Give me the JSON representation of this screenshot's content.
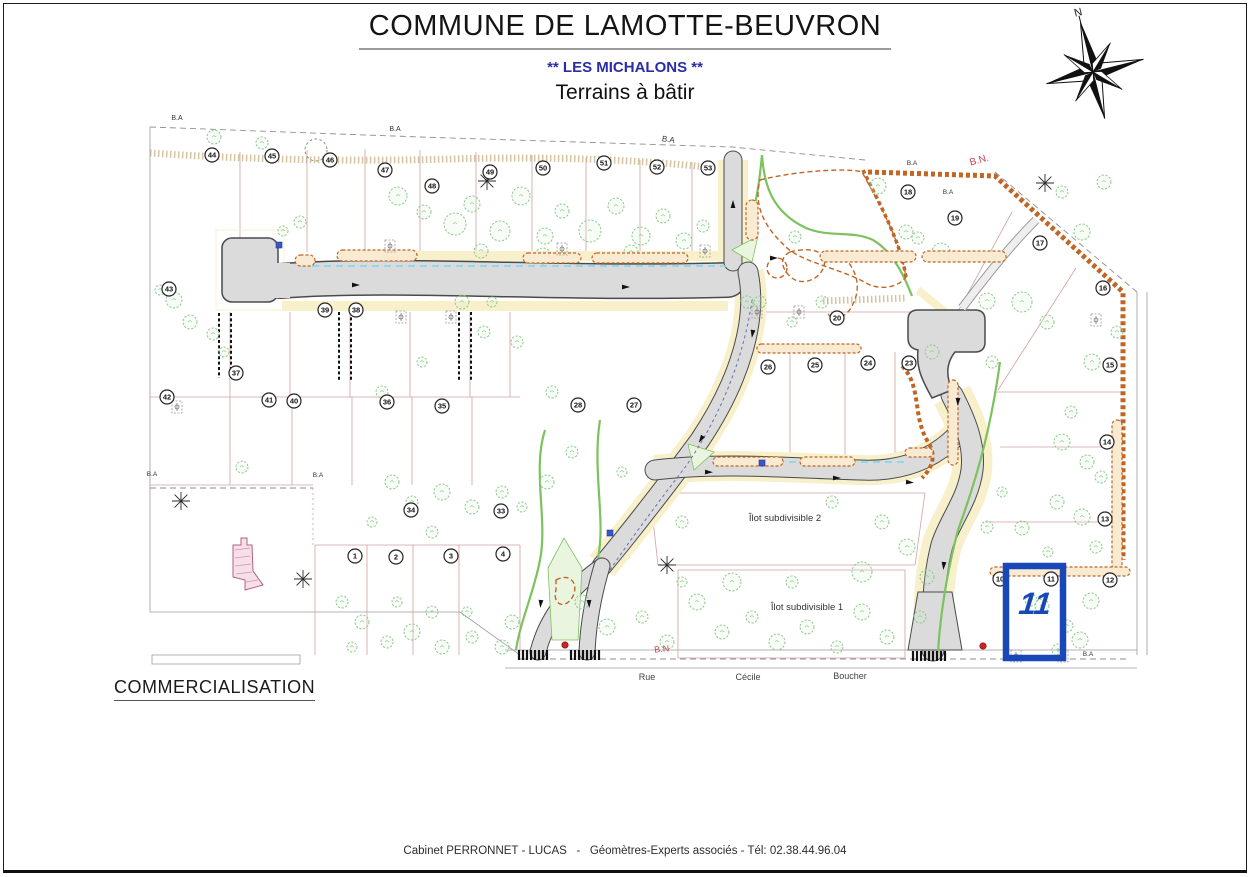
{
  "header": {
    "title": "COMMUNE DE LAMOTTE-BEUVRON",
    "subtitle": "** LES MICHALONS **",
    "subtitle2": "Terrains à bâtir"
  },
  "compass": {
    "label": "N"
  },
  "commercialisation": "COMMERCIALISATION",
  "footer": {
    "credit": "Cabinet PERRONNET - LUCAS   -   Géomètres-Experts associés - Tél: 02.38.44.96.04"
  },
  "map": {
    "colors": {
      "road": "#dbdbdb",
      "road_edge": "#4a4a4a",
      "sidewalk": "#f8f0cb",
      "tree": "#8cc98c",
      "hedge": "#c06524",
      "plot_line": "#d2a0a0",
      "water": "#86d8ec",
      "highlight": "#1848b8",
      "label_red": "#cc4455"
    },
    "highlight": {
      "number": "11",
      "x": 1006,
      "y": 566,
      "w": 57,
      "h": 92
    },
    "labels": [
      {
        "t": "B.A",
        "x": 177,
        "y": 120,
        "s": 7,
        "c": "#333",
        "r": 0
      },
      {
        "t": "B.A",
        "x": 395,
        "y": 131,
        "s": 7,
        "c": "#333",
        "r": 0
      },
      {
        "t": "B.A",
        "x": 668,
        "y": 142,
        "s": 8,
        "c": "#333",
        "r": 8
      },
      {
        "t": "B.A",
        "x": 912,
        "y": 165,
        "s": 6.5,
        "c": "#333",
        "r": 0
      },
      {
        "t": "B.A",
        "x": 948,
        "y": 194,
        "s": 6.5,
        "c": "#333",
        "r": 0
      },
      {
        "t": "B.A",
        "x": 152,
        "y": 476,
        "s": 6.5,
        "c": "#333",
        "r": 0
      },
      {
        "t": "B.A",
        "x": 318,
        "y": 477,
        "s": 6.5,
        "c": "#333",
        "r": 0
      },
      {
        "t": "B.A",
        "x": 1088,
        "y": 656,
        "s": 6.5,
        "c": "#333",
        "r": 0
      },
      {
        "t": "B.N.",
        "x": 980,
        "y": 163,
        "s": 10,
        "c": "#cc4455",
        "r": -16
      },
      {
        "t": "B.N",
        "x": 662,
        "y": 652,
        "s": 9,
        "c": "#cc4455",
        "r": -6
      },
      {
        "t": "Îlot subdivisible 2",
        "x": 785,
        "y": 521,
        "s": 9.5,
        "c": "#333",
        "r": 0
      },
      {
        "t": "Îlot subdivisible 1",
        "x": 807,
        "y": 610,
        "s": 9.5,
        "c": "#333",
        "r": 0
      },
      {
        "t": "Rue",
        "x": 647,
        "y": 680,
        "s": 9,
        "c": "#444",
        "r": 0
      },
      {
        "t": "Cécile",
        "x": 748,
        "y": 680,
        "s": 9,
        "c": "#444",
        "r": 0
      },
      {
        "t": "Boucher",
        "x": 850,
        "y": 679,
        "s": 9,
        "c": "#444",
        "r": 0
      }
    ],
    "plot_numbers": [
      {
        "n": "44",
        "x": 212,
        "y": 155
      },
      {
        "n": "45",
        "x": 272,
        "y": 156
      },
      {
        "n": "46",
        "x": 330,
        "y": 160
      },
      {
        "n": "47",
        "x": 385,
        "y": 170
      },
      {
        "n": "48",
        "x": 432,
        "y": 186
      },
      {
        "n": "49",
        "x": 490,
        "y": 172
      },
      {
        "n": "50",
        "x": 543,
        "y": 168
      },
      {
        "n": "51",
        "x": 604,
        "y": 163
      },
      {
        "n": "52",
        "x": 657,
        "y": 167
      },
      {
        "n": "53",
        "x": 708,
        "y": 168
      },
      {
        "n": "18",
        "x": 908,
        "y": 192
      },
      {
        "n": "19",
        "x": 955,
        "y": 218
      },
      {
        "n": "17",
        "x": 1040,
        "y": 243
      },
      {
        "n": "16",
        "x": 1103,
        "y": 288
      },
      {
        "n": "15",
        "x": 1110,
        "y": 365
      },
      {
        "n": "14",
        "x": 1107,
        "y": 442
      },
      {
        "n": "13",
        "x": 1105,
        "y": 519
      },
      {
        "n": "12",
        "x": 1110,
        "y": 580
      },
      {
        "n": "11",
        "x": 1051,
        "y": 579
      },
      {
        "n": "10",
        "x": 1000,
        "y": 579
      },
      {
        "n": "20",
        "x": 837,
        "y": 318
      },
      {
        "n": "26",
        "x": 768,
        "y": 367
      },
      {
        "n": "25",
        "x": 815,
        "y": 365
      },
      {
        "n": "24",
        "x": 868,
        "y": 363
      },
      {
        "n": "23",
        "x": 909,
        "y": 363
      },
      {
        "n": "43",
        "x": 169,
        "y": 289
      },
      {
        "n": "39",
        "x": 325,
        "y": 310
      },
      {
        "n": "38",
        "x": 356,
        "y": 310
      },
      {
        "n": "37",
        "x": 236,
        "y": 373
      },
      {
        "n": "36",
        "x": 387,
        "y": 402
      },
      {
        "n": "35",
        "x": 442,
        "y": 406
      },
      {
        "n": "42",
        "x": 167,
        "y": 397
      },
      {
        "n": "41",
        "x": 269,
        "y": 400
      },
      {
        "n": "40",
        "x": 294,
        "y": 401
      },
      {
        "n": "34",
        "x": 411,
        "y": 510
      },
      {
        "n": "33",
        "x": 501,
        "y": 511
      },
      {
        "n": "28",
        "x": 578,
        "y": 405
      },
      {
        "n": "27",
        "x": 634,
        "y": 405
      },
      {
        "n": "1",
        "x": 355,
        "y": 556
      },
      {
        "n": "2",
        "x": 396,
        "y": 557
      },
      {
        "n": "3",
        "x": 451,
        "y": 556
      },
      {
        "n": "4",
        "x": 503,
        "y": 554
      }
    ],
    "trees": [
      [
        398,
        196,
        9
      ],
      [
        424,
        212,
        7
      ],
      [
        455,
        224,
        11
      ],
      [
        472,
        204,
        8
      ],
      [
        500,
        231,
        10
      ],
      [
        521,
        196,
        9
      ],
      [
        545,
        236,
        8
      ],
      [
        562,
        211,
        7
      ],
      [
        590,
        231,
        11
      ],
      [
        616,
        206,
        8
      ],
      [
        641,
        236,
        9
      ],
      [
        663,
        216,
        7
      ],
      [
        684,
        241,
        8
      ],
      [
        703,
        226,
        6
      ],
      [
        631,
        252,
        7
      ],
      [
        543,
        256,
        8
      ],
      [
        481,
        251,
        7
      ],
      [
        300,
        222,
        6
      ],
      [
        283,
        231,
        5
      ],
      [
        214,
        137,
        7
      ],
      [
        262,
        143,
        6
      ],
      [
        174,
        300,
        8
      ],
      [
        190,
        322,
        7
      ],
      [
        213,
        334,
        6
      ],
      [
        160,
        290,
        5
      ],
      [
        224,
        352,
        5
      ],
      [
        878,
        186,
        8
      ],
      [
        906,
        232,
        7
      ],
      [
        941,
        252,
        9
      ],
      [
        987,
        301,
        8
      ],
      [
        1022,
        302,
        10
      ],
      [
        1047,
        322,
        7
      ],
      [
        1082,
        232,
        8
      ],
      [
        1104,
        182,
        7
      ],
      [
        1062,
        192,
        6
      ],
      [
        932,
        352,
        7
      ],
      [
        992,
        362,
        6
      ],
      [
        1092,
        362,
        8
      ],
      [
        1117,
        332,
        6
      ],
      [
        918,
        238,
        6
      ],
      [
        795,
        237,
        6
      ],
      [
        760,
        302,
        6
      ],
      [
        792,
        322,
        5
      ],
      [
        822,
        302,
        6
      ],
      [
        1062,
        442,
        8
      ],
      [
        1087,
        462,
        7
      ],
      [
        1101,
        477,
        6
      ],
      [
        1057,
        502,
        7
      ],
      [
        1082,
        517,
        8
      ],
      [
        1096,
        547,
        6
      ],
      [
        1042,
        606,
        7
      ],
      [
        1067,
        626,
        6
      ],
      [
        1091,
        601,
        8
      ],
      [
        1071,
        412,
        6
      ],
      [
        382,
        392,
        6
      ],
      [
        422,
        362,
        5
      ],
      [
        462,
        302,
        7
      ],
      [
        484,
        332,
        6
      ],
      [
        392,
        482,
        7
      ],
      [
        412,
        502,
        6
      ],
      [
        442,
        492,
        8
      ],
      [
        472,
        507,
        7
      ],
      [
        502,
        492,
        6
      ],
      [
        522,
        507,
        5
      ],
      [
        547,
        482,
        7
      ],
      [
        432,
        532,
        6
      ],
      [
        372,
        522,
        5
      ],
      [
        242,
        467,
        6
      ],
      [
        342,
        602,
        6
      ],
      [
        362,
        622,
        7
      ],
      [
        387,
        642,
        6
      ],
      [
        412,
        632,
        8
      ],
      [
        442,
        647,
        7
      ],
      [
        472,
        637,
        6
      ],
      [
        502,
        647,
        7
      ],
      [
        397,
        602,
        5
      ],
      [
        432,
        612,
        6
      ],
      [
        467,
        612,
        5
      ],
      [
        512,
        622,
        7
      ],
      [
        352,
        647,
        5
      ],
      [
        582,
        602,
        7
      ],
      [
        607,
        627,
        8
      ],
      [
        642,
        617,
        6
      ],
      [
        667,
        642,
        7
      ],
      [
        697,
        602,
        8
      ],
      [
        722,
        632,
        7
      ],
      [
        752,
        617,
        6
      ],
      [
        777,
        642,
        8
      ],
      [
        807,
        627,
        7
      ],
      [
        837,
        647,
        6
      ],
      [
        862,
        612,
        8
      ],
      [
        887,
        637,
        7
      ],
      [
        732,
        582,
        9
      ],
      [
        862,
        572,
        10
      ],
      [
        792,
        582,
        6
      ],
      [
        682,
        582,
        5
      ],
      [
        572,
        452,
        6
      ],
      [
        622,
        472,
        5
      ],
      [
        682,
        522,
        6
      ],
      [
        832,
        502,
        6
      ],
      [
        882,
        522,
        7
      ],
      [
        907,
        547,
        8
      ],
      [
        927,
        577,
        7
      ],
      [
        1002,
        492,
        5
      ],
      [
        987,
        527,
        6
      ],
      [
        747,
        302,
        6
      ],
      [
        552,
        392,
        6
      ],
      [
        517,
        342,
        6
      ],
      [
        492,
        302,
        5
      ],
      [
        1022,
        528,
        7
      ],
      [
        1031,
        600,
        6
      ],
      [
        1048,
        552,
        5
      ],
      [
        1080,
        640,
        8
      ],
      [
        1058,
        650,
        6
      ],
      [
        920,
        617,
        6
      ]
    ],
    "conifers": [
      [
        181,
        501
      ],
      [
        303,
        579
      ],
      [
        667,
        565
      ],
      [
        487,
        181
      ],
      [
        1045,
        183
      ]
    ],
    "lamps": [
      [
        390,
        246
      ],
      [
        562,
        249
      ],
      [
        705,
        251
      ],
      [
        401,
        317
      ],
      [
        451,
        317
      ],
      [
        757,
        312
      ],
      [
        799,
        312
      ],
      [
        1096,
        320
      ],
      [
        177,
        407
      ],
      [
        1016,
        656
      ],
      [
        1063,
        656
      ]
    ],
    "hedge_capsules": [
      [
        295,
        255,
        20,
        11
      ],
      [
        337,
        250,
        80,
        11
      ],
      [
        523,
        253,
        58,
        10
      ],
      [
        592,
        253,
        96,
        10
      ],
      [
        820,
        251,
        96,
        11
      ],
      [
        922,
        251,
        84,
        11
      ],
      [
        757,
        344,
        104,
        9
      ],
      [
        713,
        457,
        70,
        9
      ],
      [
        800,
        457,
        55,
        9
      ],
      [
        905,
        448,
        28,
        9
      ],
      [
        948,
        380,
        10,
        85
      ],
      [
        1112,
        420,
        10,
        150
      ],
      [
        746,
        200,
        12,
        40
      ],
      [
        990,
        567,
        140,
        9
      ]
    ],
    "arrows": [
      [
        352,
        285,
        0
      ],
      [
        622,
        287,
        0
      ],
      [
        733,
        208,
        -90
      ],
      [
        753,
        330,
        98
      ],
      [
        703,
        436,
        122
      ],
      [
        541,
        600,
        95
      ],
      [
        589,
        600,
        88
      ],
      [
        833,
        478,
        0
      ],
      [
        705,
        472,
        2
      ],
      [
        958,
        398,
        92
      ],
      [
        944,
        562,
        95
      ],
      [
        906,
        482,
        5
      ],
      [
        770,
        258,
        0
      ]
    ],
    "hydrants": [
      [
        565,
        645
      ],
      [
        983,
        646
      ]
    ],
    "signs": [
      [
        610,
        533
      ],
      [
        762,
        463
      ],
      [
        279,
        245
      ]
    ]
  }
}
